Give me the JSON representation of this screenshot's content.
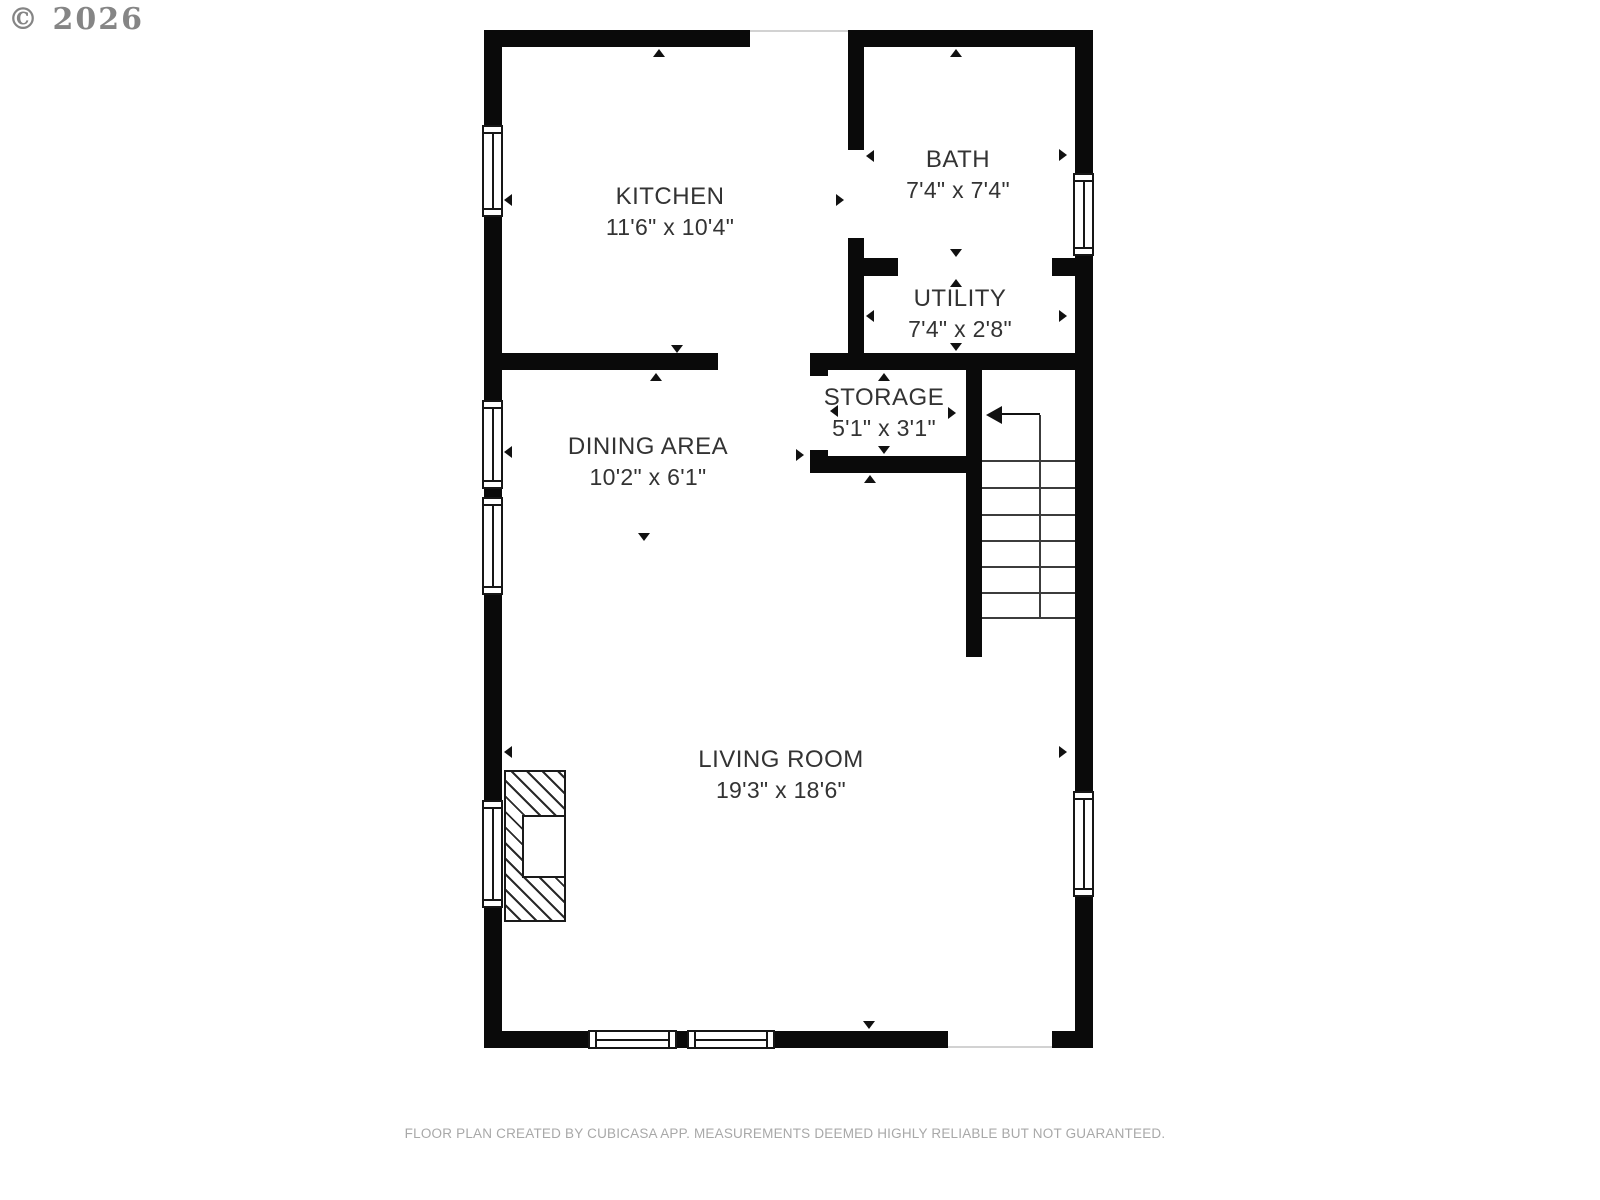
{
  "copyright": "© 2026",
  "rooms": [
    {
      "name": "KITCHEN",
      "dims": "11'6\" x 10'4\""
    },
    {
      "name": "BATH",
      "dims": "7'4\" x 7'4\""
    },
    {
      "name": "UTILITY",
      "dims": "7'4\" x 2'8\""
    },
    {
      "name": "STORAGE",
      "dims": "5'1\" x 3'1\""
    },
    {
      "name": "DINING AREA",
      "dims": "10'2\" x 6'1\""
    },
    {
      "name": "LIVING ROOM",
      "dims": "19'3\" x 18'6\""
    }
  ],
  "footer": "FLOOR PLAN CREATED BY CUBICASA APP. MEASUREMENTS DEEMED HIGHLY RELIABLE BUT NOT GUARANTEED.",
  "colors": {
    "wall": "#000000",
    "room_text": "#333333",
    "footer_text": "#a8a8a8",
    "copyright_text": "#858585",
    "background": "#ffffff"
  }
}
